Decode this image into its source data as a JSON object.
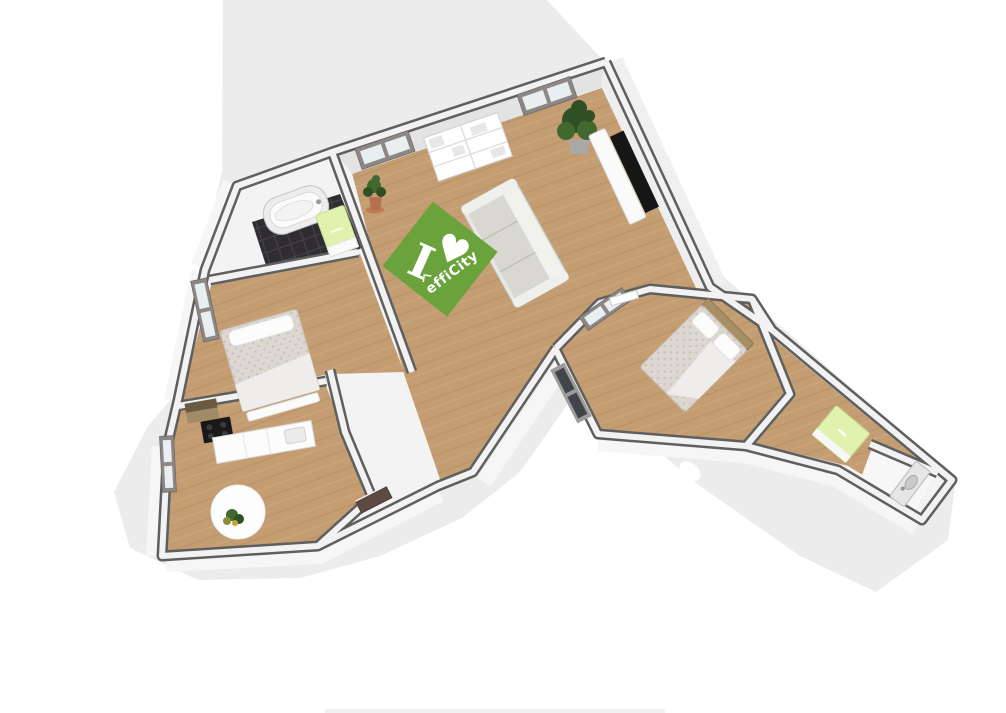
{
  "scene": {
    "type": "3d-floorplan-render",
    "watermark": {
      "word": "I",
      "heart": "♥",
      "brand": "effiCity"
    },
    "rooms": [
      {
        "name": "living-room",
        "furniture": [
          "sofa",
          "bookshelf",
          "tv",
          "tv-stand",
          "corner-plant",
          "floor-plant",
          "efficity-watermark",
          "window",
          "window"
        ]
      },
      {
        "name": "bathroom",
        "furniture": [
          "bathtub",
          "radiator-cabinet",
          "dark-tile-floor"
        ]
      },
      {
        "name": "bedroom-left",
        "furniture": [
          "double-bed",
          "foot-bench",
          "window"
        ]
      },
      {
        "name": "kitchen",
        "furniture": [
          "counter",
          "cooktop",
          "hood-cabinet",
          "round-rug",
          "table-plant",
          "window"
        ]
      },
      {
        "name": "bedroom-right",
        "furniture": [
          "double-bed",
          "headboard",
          "pillows",
          "window",
          "glazed-door"
        ]
      },
      {
        "name": "corridor",
        "furniture": [
          "green-cabinet",
          "door-leaf"
        ]
      },
      {
        "name": "wc",
        "furniture": [
          "washbasin"
        ]
      },
      {
        "name": "entrance",
        "furniture": [
          "front-door"
        ]
      }
    ]
  },
  "palette": {
    "bg": "#ffffff",
    "shadow": "#ececec",
    "wood": "#c49e72",
    "wood_line": "#a9855c",
    "wall_edge": "#5f5f5f",
    "wall_core": "#f2f2f2",
    "wall_face": "#e3e3e3",
    "tile": "#2f2d31",
    "tile_line": "#47454a",
    "logo_green": "#6aa23c",
    "duvet": "#dcd7d1",
    "duvet_dot": "#c6beb5",
    "sheet": "#efedeb",
    "pillow": "#fcfcfc",
    "plant_dark": "#2f4f24",
    "plant_mid": "#41682e",
    "pot": "#b5714e",
    "tv": "#161616",
    "wood_furn": "#a98f66",
    "green_cab": "#e0f2ae",
    "door_brown": "#5d4a42",
    "window_frame": "#8d8886",
    "window_pane": "#e9eef1",
    "divider": "#f1f1f1"
  },
  "footer": {
    "divider_visible": true
  }
}
